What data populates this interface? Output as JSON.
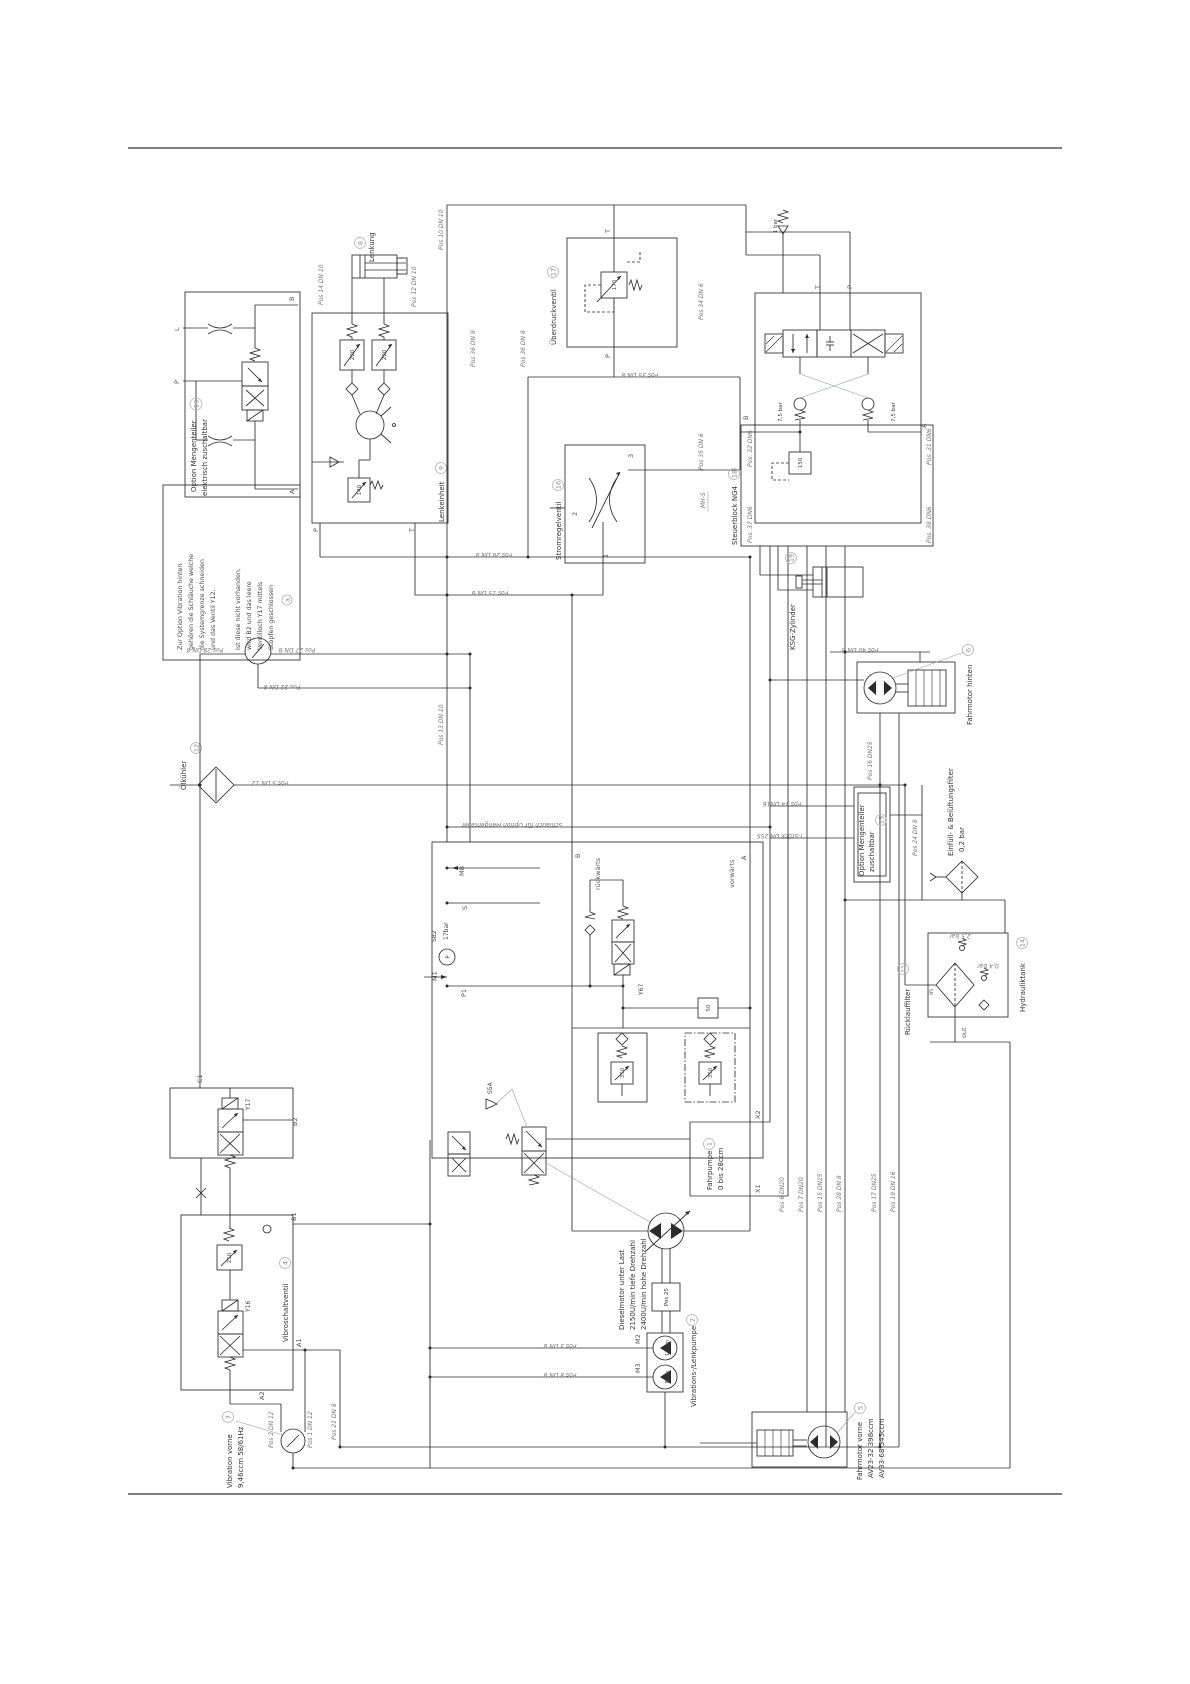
{
  "page": {
    "bg": "#ffffff",
    "line_color": "#2b2b2b"
  },
  "note": {
    "line1": "Zur Option Vibration hinten",
    "line2": "gehören die Schläuche welche",
    "line3": "die Systemgrenze schneiden",
    "line4": "und das Ventil Y12.",
    "line5": "Ist diese nicht vorhanden,",
    "line6": "wird B2 und das leere",
    "line7": "Ventilloch Y17 mittels",
    "line8": "Stopfen geschlossen",
    "badge": "a"
  },
  "c": {
    "m13": {
      "name": "Option Mengenteiler",
      "name2": "elektrisch zuschaltbar",
      "num": "13"
    },
    "lenkung": {
      "name": "Lenkung",
      "num": "8"
    },
    "lenkeinheit": {
      "name": "Lenkeinheit",
      "num": "9",
      "relief1": "200",
      "relief2": "200",
      "relief3": "140"
    },
    "ueber": {
      "name": "Überdruckventil",
      "num": "17",
      "relief": "170"
    },
    "strom": {
      "name": "Stromregelventil",
      "num": "16"
    },
    "steuer": {
      "name": "Steuerblock NG4",
      "num": "18",
      "relief": "150",
      "check1": "7,5 bar",
      "check2": "7,5 bar",
      "check_top": "1 bar"
    },
    "ksg": {
      "name": "KSG-Zylinder",
      "num": "19"
    },
    "fmh": {
      "name": "Fahrmotor hinten",
      "num": "6"
    },
    "oel": {
      "name": "Ölkühler",
      "num": "12"
    },
    "fp": {
      "name": "Fahrpumpe",
      "disp": "0 bis 28ccm",
      "num": "1",
      "servo": "Y67",
      "lever": "S5A",
      "gauge": "SB2",
      "gauge_val": "17bar",
      "gauge_p": "P",
      "relief_feed": "50",
      "relief_a": "350",
      "relief_b": "350"
    },
    "diesel": {
      "line1": "Dieselmotor unter Last",
      "line2": "2150U/min tiefe Drehzahl",
      "line3": "2400U/min hohe Drehzahl",
      "pos": "Pos 25"
    },
    "vlp": {
      "name": "Vibrations-/Lenkpumpe",
      "num": "2",
      "disp1": "14ccm",
      "disp2": "8ccm"
    },
    "vsv": {
      "name": "Vibroschaltventil",
      "num": "4",
      "v1": "Y17",
      "v2": "Y16",
      "relief": "210"
    },
    "vib7": {
      "name": "Vibration vorne",
      "num": "7",
      "spec": "9,46ccm 58/61Hz"
    },
    "fmv": {
      "name": "Fahrmotor vorne",
      "num": "5",
      "spec1": "AV23-32 398ccm",
      "spec2": "AV33-68 545ccm"
    },
    "m15": {
      "name": "Option Mengenteiler",
      "name2": "zuschaltbar",
      "num": "15"
    },
    "eff": {
      "name": "Einfüll- & Belüftungsfilter",
      "val": "0,2 bar"
    },
    "rlf": {
      "name": "Rücklauffilter",
      "num": "11",
      "bypass": "2,5 bar",
      "val2": "0,4 bar"
    },
    "tank": {
      "name": "Hydrauliktank",
      "num": "14"
    }
  },
  "ports": {
    "l": "L",
    "p": "P",
    "t": "T",
    "b": "B",
    "a": "A",
    "mb": "MB",
    "s": "S",
    "p1": "P1",
    "m1": "M1",
    "m2": "M2",
    "m3": "M3",
    "x1": "X1",
    "x2": "X2",
    "c1": "C1",
    "b1": "B1",
    "b2": "B2",
    "a1": "A1",
    "a2": "A2",
    "in_": "in",
    "out": "out",
    "mhs": "MH-S",
    "rueck": "rückwärts",
    "vor": "vorwärts",
    "n1": "1",
    "n2": "2",
    "n3": "3"
  },
  "pos": {
    "p10dn10": "Pos 10 DN 10",
    "p14dn10": "Pos 14 DN 10",
    "p12dn10": "Pos 12 DN 10",
    "p36dn8": "Pos 36 DN 8",
    "p34dn6": "Pos 34 DN 6",
    "p35dn6": "Pos 35 DN 6",
    "p35dn8": "Pos 35 DN 8",
    "p32dn6": "Pos. 32 DN6",
    "p37dn6": "Pos. 37 DN6",
    "p31dn6": "Pos. 31 DN6",
    "p38dn6": "Pos. 38 DN6",
    "p16dn25": "Pos 16 DN25",
    "p24dn8": "Pos 24 DN 8",
    "p40dn8": "Pos 40 DN 8",
    "p13dn10": "Pos 13 DN 10",
    "p28dn8": "Pos 28 DN 8",
    "p15dn8": "Pos 15 DN 8",
    "p27dn8": "Pos 27 DN 8",
    "p22dn8": "Pos 22 DN 8",
    "p5dn12": "Pos 5 DN 12",
    "schlauch": "Schlauch für Option Mengenteiler",
    "p14dn16": "Pos 14 DN16",
    "tstueck": "T-Stück DN 25S",
    "p6dn20": "Pos 6 DN20",
    "p7dn20": "Pos 7 DN20",
    "p15dn25": "Pos 15 DN25",
    "p17dn25": "Pos 17 DN25",
    "p19dn16": "Pos 19 DN 16",
    "p2dn12": "Pos 2 DN 12",
    "p1dn12": "Pos 1 DN 12",
    "p21dn8": "Pos 21 DN 8",
    "p3dn8": "Pos 3 DN 8",
    "p8dn8": "Pos 8 DN 8"
  }
}
